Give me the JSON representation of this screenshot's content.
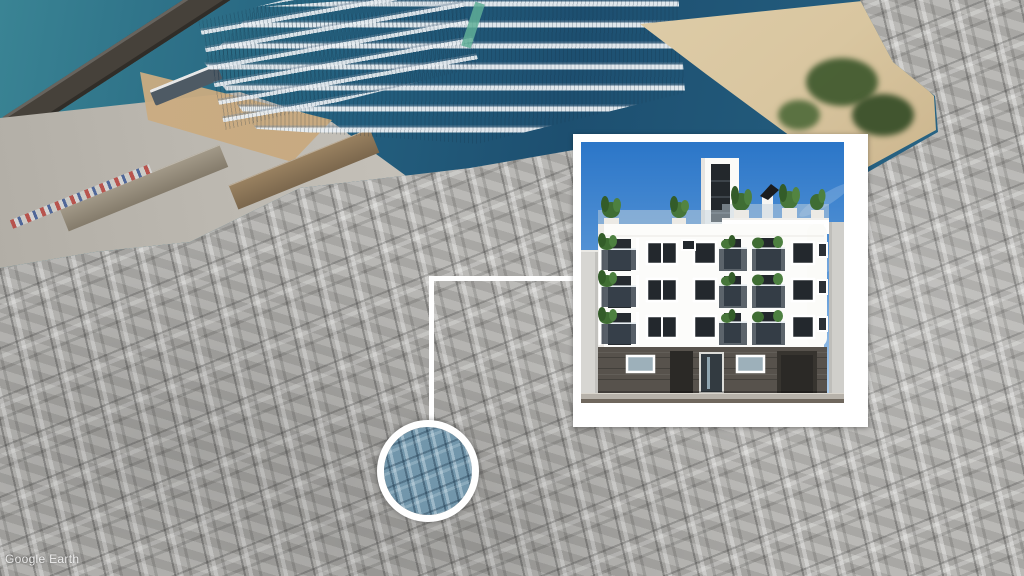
{
  "watermark": {
    "brand": "Google Earth"
  },
  "icons": {
    "location_marker": "circle-highlight-icon",
    "connector": "callout-line",
    "inset_frame": "photo-inset-border"
  },
  "colors": {
    "city-gray": "#b2b1ae",
    "sea-teal": "#3a8494",
    "sea-deep": "#1d4f70",
    "shallow-turquoise": "#7ac2cb",
    "sand": "#d9c6a0",
    "sky-top": "#2b76c8",
    "sky-low": "#b5d2ee",
    "facade-white": "#fcfcfa",
    "ground-dark": "#57524c",
    "window-dark": "#23282d",
    "railing-glass": "#39434d",
    "plant-green": "#47763a",
    "marker-tint": "#7296ab",
    "marker-ring": "#ffffff",
    "connector-white": "#ffffff",
    "inset-border": "#ffffff",
    "road-brown": "#6f675d"
  }
}
